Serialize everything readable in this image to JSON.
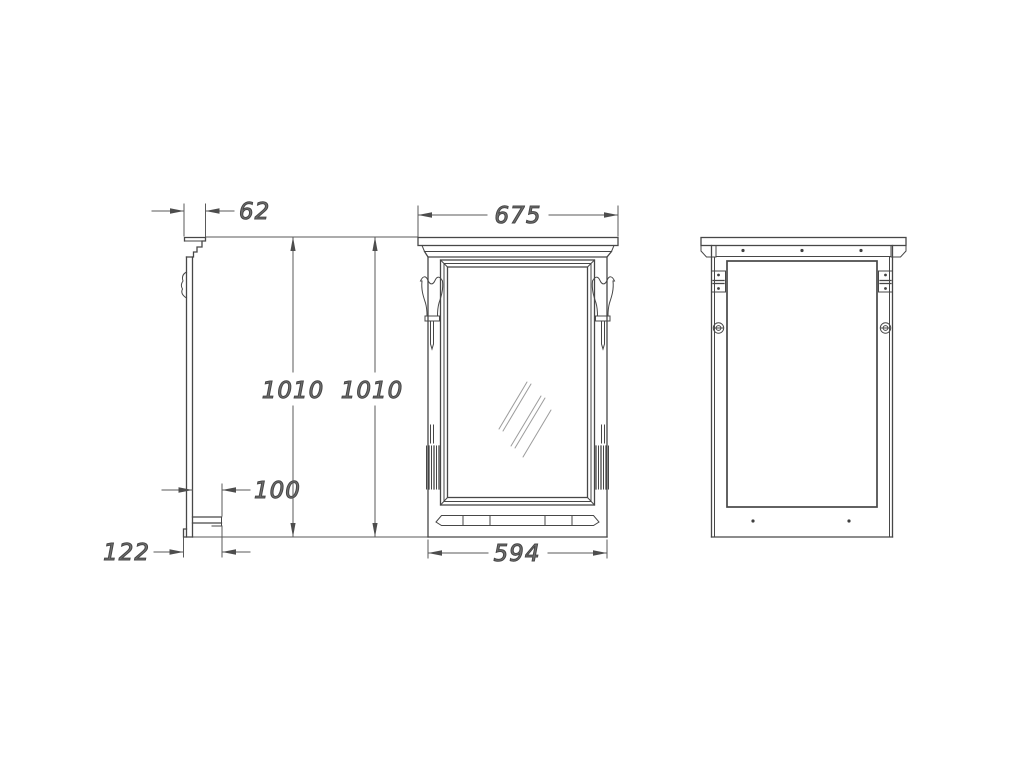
{
  "drawing": {
    "type": "furniture-technical-drawing",
    "subject": "wall mirror with cornice, sconces and shelf — side, front and back views",
    "dimensions": {
      "cornice_depth": "62",
      "side_overall_height": "1010",
      "front_overall_height": "1010",
      "shelf_depth": "100",
      "base_depth": "122",
      "cornice_width": "675",
      "body_width": "594"
    },
    "colors": {
      "line": "#474747",
      "dim_line": "#5a5a5a",
      "dim_text": "#6f6f6f",
      "background": "#ffffff"
    }
  }
}
